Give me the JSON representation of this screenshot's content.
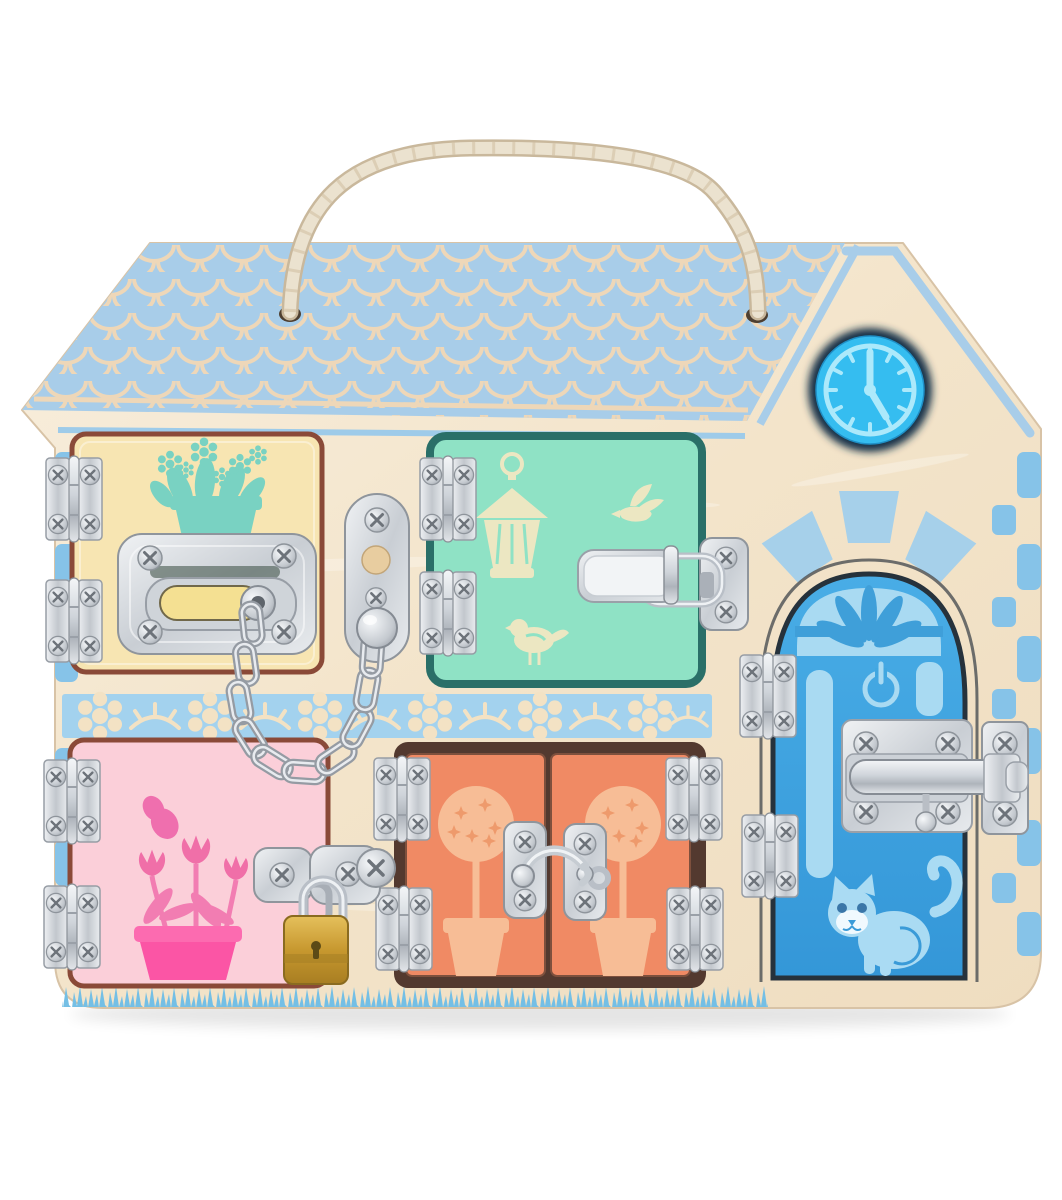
{
  "scene": {
    "alt": "Wooden busy board shaped like a house with five pastel doors fitted with metal locks and latches, a rope carry handle, a blue clock in the gable, scalloped blue roof, brick side borders, a floral band and blue grass",
    "background_color": "#ffffff"
  },
  "board": {
    "wood_color": "#f4e6d0",
    "rope": {
      "color": "#ebe2cf",
      "holes": 2
    },
    "roof": {
      "fill": "#a8cde9",
      "shingle_line_color": "#eed7b8",
      "style": "scalloped shingles"
    },
    "gable": {
      "outline_color": "#a8cde9"
    },
    "clock": {
      "face_color": "#35bdf0",
      "marks_color": "#ace9fb",
      "time": "5:00"
    },
    "side_bricks_color": "#86c3e8",
    "floral_band": {
      "background": "#a3d2ee",
      "ornament_color": "#f3e2c4",
      "motifs": [
        "daisy",
        "leaf-sprig"
      ]
    },
    "grass_color": "#74bfe5"
  },
  "doors": [
    {
      "name": "yellow window door",
      "position": "top-left",
      "face_color": "#f7e5b2",
      "frame_color": "#8a4a38",
      "motif": "flower box",
      "motif_color": "#79d2c2",
      "hardware": [
        "door chain lock",
        "2 hinges"
      ]
    },
    {
      "name": "mint window door",
      "position": "top-middle",
      "face_color": "#8fe2c5",
      "frame_color": "#2a6f68",
      "motif": "lantern and two birds",
      "motif_color": "#ece7c2",
      "hardware": [
        "draw latch",
        "2 hinges"
      ]
    },
    {
      "name": "pink door",
      "position": "bottom-left",
      "face_color": "#fbcfd9",
      "frame_color": "#8a4a38",
      "motif": "butterfly and tulips in pot",
      "motif_color": "#ef6fae",
      "pot_color": "#fb55a5",
      "hardware": [
        "hasp with brass padlock",
        "2 hinges"
      ]
    },
    {
      "name": "orange double doors",
      "position": "bottom-middle",
      "face_color": "#f08a64",
      "frame_color": "#4a332c",
      "motif": "topiary trees",
      "motif_color": "#f7bd96",
      "hardware": [
        "swing hook latch",
        "4 hinges"
      ]
    },
    {
      "name": "blue front door",
      "position": "right",
      "shape": "arched",
      "face_color": "#41a7e0",
      "frame_color": "#26323c",
      "motif": "fanlight, power symbol and cat",
      "motif_color": "#a9daf2",
      "hardware": [
        "barrel bolt",
        "2 hinges"
      ]
    }
  ],
  "hardware": {
    "metal_color": "#d8dce1",
    "chain_color": "#b9bfc7",
    "padlock_body_color": "#c7982f",
    "hinge_count": 12
  }
}
